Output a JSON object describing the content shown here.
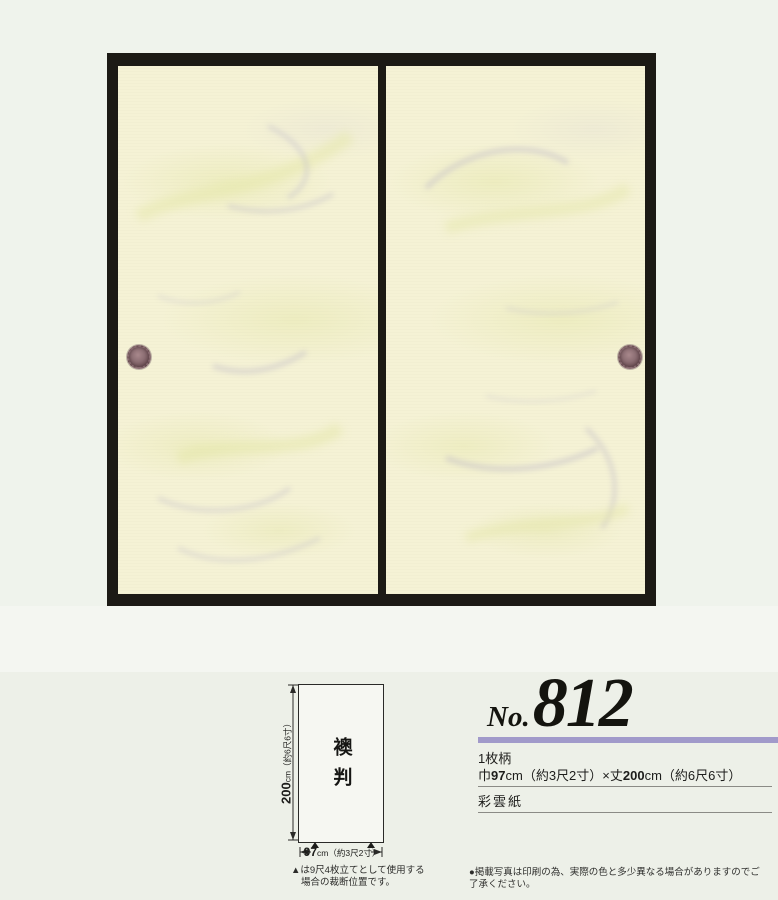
{
  "colors": {
    "accent_purple": "#a19aca",
    "frame_black": "#1c1a15",
    "paper_cream": "#f5f2d5"
  },
  "title": {
    "prefix": "No.",
    "number": "812"
  },
  "details": {
    "pattern_type": "1枚柄",
    "size_width_label": "巾",
    "size_width_value": "97",
    "size_width_suffix": "cm（約3尺2寸）×丈",
    "size_height_value": "200",
    "size_height_suffix": "cm（約6尺6寸）",
    "paper_name": "彩雲紙"
  },
  "diagram": {
    "panel_label": "襖判",
    "height_value": "200",
    "height_suffix": "cm（約6尺6寸）",
    "width_value": "97",
    "width_suffix": "cm（約3尺2寸）",
    "cut_note_line1": "▲は9尺4枚立てとして使用する",
    "cut_note_line2": "場合の裁断位置です。"
  },
  "footer": {
    "photo_note": "●掲載写真は印刷の為、実際の色と多少異なる場合がありますのでご了承ください。"
  }
}
